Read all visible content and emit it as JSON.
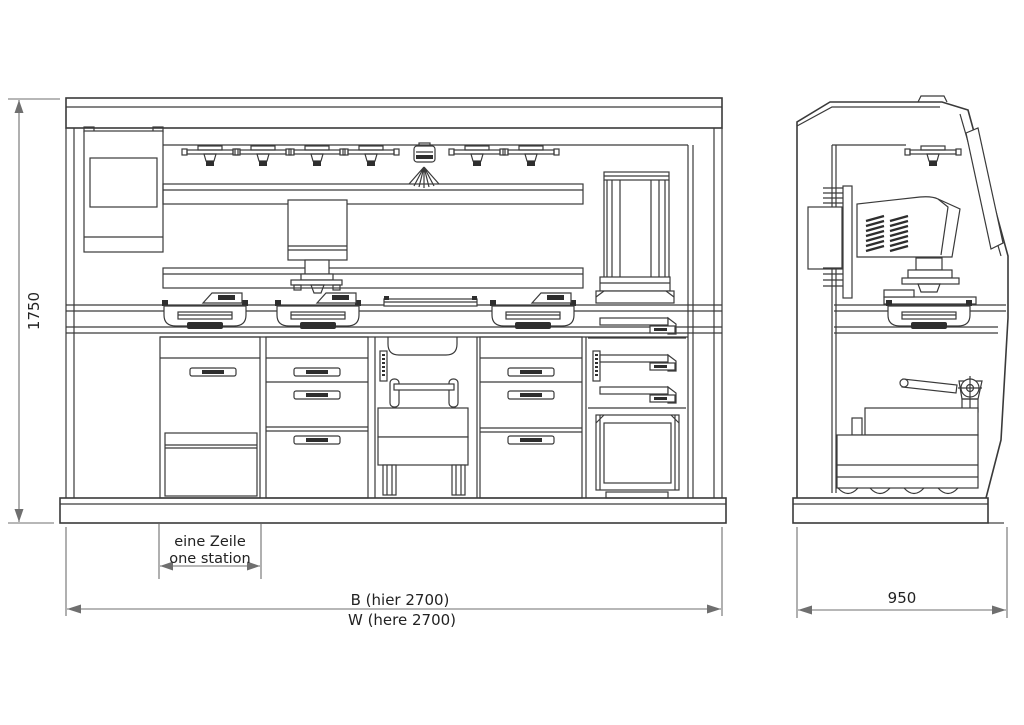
{
  "labels": {
    "height": "1750",
    "width_line1": "B (hier 2700)",
    "width_line2": "W (here 2700)",
    "depth": "950",
    "station_line1": "eine Zeile",
    "station_line2": "one station"
  },
  "colors": {
    "background": "#ffffff",
    "drawing_line": "#3a3a3a",
    "dimension_line": "#6f6f6f",
    "text": "#222222"
  }
}
